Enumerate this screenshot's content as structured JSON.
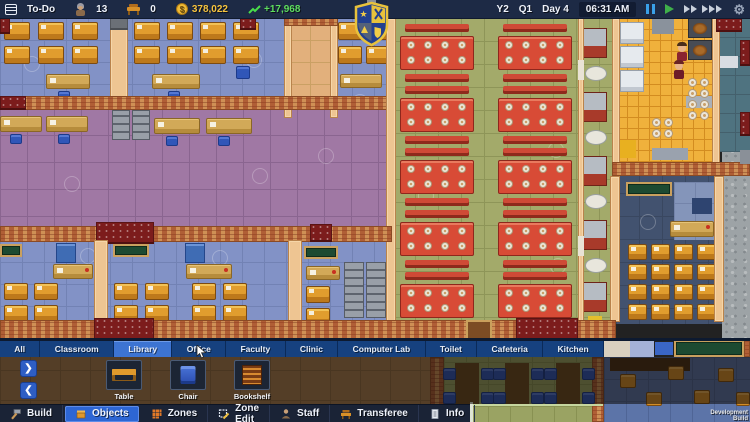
{
  "top_bar": {
    "todo_label": "To-Do",
    "students_count": "13",
    "desks_count": "0",
    "money": "378,022",
    "income": "+17,968",
    "date_year": "Y2",
    "date_quarter": "Q1",
    "date_day": "Day 4",
    "time": "06:31 AM"
  },
  "tabs": {
    "selected": "Library",
    "items": [
      "All",
      "Classroom",
      "Library",
      "Office",
      "Faculty",
      "Clinic",
      "Computer Lab",
      "Toilet",
      "Cafeteria",
      "Kitchen"
    ]
  },
  "palette": {
    "items": [
      {
        "label": "Table",
        "icon": "table-icon"
      },
      {
        "label": "Chair",
        "icon": "chair-icon"
      },
      {
        "label": "Bookshelf",
        "icon": "bookshelf-icon"
      }
    ]
  },
  "bottom_bar": {
    "items": [
      {
        "label": "Build",
        "icon": "hammer-icon",
        "selected": false
      },
      {
        "label": "Objects",
        "icon": "box-icon",
        "selected": true
      },
      {
        "label": "Zones",
        "icon": "zones-grid-icon",
        "selected": false
      },
      {
        "label": "Zone Edit",
        "icon": "zone-edit-icon",
        "selected": false
      },
      {
        "label": "Staff",
        "icon": "staff-person-icon",
        "selected": false
      },
      {
        "label": "Transferee",
        "icon": "transferee-desk-icon",
        "selected": false
      },
      {
        "label": "Info",
        "icon": "info-book-icon",
        "selected": false
      }
    ]
  },
  "watermark": "Development Build",
  "colors": {
    "topbar_bg": "#1d2a45",
    "tab_bg": "#16417f",
    "tab_selected": "#3d74d2",
    "button_selected": "#2d66d4",
    "money_yellow": "#f6c33e",
    "income_green": "#5ede5e",
    "classroom_floor": "#8292c6",
    "hall_floor": "#a078a4",
    "cafeteria_floor": "#a3aa6a",
    "kitchen_floor": "#f0b13c"
  },
  "map": {
    "items": [
      {
        "t": "floor",
        "x": 0,
        "y": 18,
        "w": 392,
        "h": 90,
        "f": "#8292c6",
        "tl": 22,
        "g": "#7282b4"
      },
      {
        "t": "floor",
        "x": 288,
        "y": 18,
        "w": 44,
        "h": 100,
        "f": "#e2b07c",
        "tl": 22,
        "g": "#caa064"
      },
      {
        "t": "floor",
        "x": 0,
        "y": 108,
        "w": 392,
        "h": 136,
        "f": "#a078a4",
        "tl": 27,
        "g": "#8a6590"
      },
      {
        "t": "floor",
        "x": 0,
        "y": 240,
        "w": 392,
        "h": 86,
        "f": "#8292c6",
        "tl": 22,
        "g": "#7282b4"
      },
      {
        "t": "floor",
        "x": 392,
        "y": 18,
        "w": 224,
        "h": 322,
        "f": "#a3aa6a",
        "tl": 23,
        "g": "#8e9558"
      },
      {
        "t": "floor",
        "x": 616,
        "y": 18,
        "w": 100,
        "h": 152,
        "f": "#f0b13c",
        "tl": 11,
        "g": "#d38c20"
      },
      {
        "t": "floor",
        "x": 716,
        "y": 18,
        "w": 34,
        "h": 134,
        "f": "#4f7380",
        "tl": 19,
        "g": "#44606c"
      },
      {
        "t": "floor",
        "x": 616,
        "y": 170,
        "w": 106,
        "h": 154,
        "f": "#42526f",
        "tl": 23,
        "g": "#394760"
      },
      {
        "t": "floor",
        "x": 674,
        "y": 182,
        "w": 42,
        "h": 58,
        "f": "#8495ba",
        "tl": 21,
        "g": "#7484aa"
      },
      {
        "t": "concrete",
        "x": 722,
        "y": 152,
        "w": 28,
        "h": 190
      },
      {
        "t": "floor",
        "x": 0,
        "y": 340,
        "w": 444,
        "h": 82,
        "f": "#a87c4e",
        "tl": 30,
        "g": "#916b42"
      },
      {
        "t": "floor",
        "x": 444,
        "y": 340,
        "w": 160,
        "h": 82,
        "f": "#9aa363",
        "tl": 22,
        "g": "#889152"
      },
      {
        "t": "floor",
        "x": 604,
        "y": 357,
        "w": 146,
        "h": 65,
        "f": "#5c74a8",
        "tl": 22,
        "g": "#4f6596"
      },
      {
        "t": "decal",
        "x": 24,
        "y": 56
      },
      {
        "t": "decal",
        "x": 246,
        "y": 52
      },
      {
        "t": "decal",
        "x": 352,
        "y": 94
      },
      {
        "t": "decal",
        "x": 64,
        "y": 176
      },
      {
        "t": "decal",
        "x": 252,
        "y": 168
      },
      {
        "t": "decal",
        "x": 318,
        "y": 148
      },
      {
        "t": "decal",
        "x": 418,
        "y": 188
      },
      {
        "t": "decal",
        "x": 548,
        "y": 142
      },
      {
        "t": "decal",
        "x": 550,
        "y": 258
      },
      {
        "t": "decal",
        "x": 80,
        "y": 248
      },
      {
        "t": "decal",
        "x": 212,
        "y": 250
      },
      {
        "t": "decal",
        "x": 640,
        "y": 214
      },
      {
        "t": "desks",
        "x": 4,
        "y": 22,
        "c": 3,
        "r": 2,
        "gx": 34,
        "gy": 24,
        "w": 26,
        "h": 18
      },
      {
        "t": "tdesk",
        "x": 46,
        "y": 74,
        "w": 44,
        "h": 15
      },
      {
        "t": "chair",
        "x": 58,
        "y": 91,
        "w": 12,
        "h": 10
      },
      {
        "t": "desks",
        "x": 134,
        "y": 22,
        "c": 4,
        "r": 2,
        "gx": 33,
        "gy": 24,
        "w": 26,
        "h": 18
      },
      {
        "t": "tdesk",
        "x": 152,
        "y": 74,
        "w": 48,
        "h": 15
      },
      {
        "t": "chair",
        "x": 168,
        "y": 91,
        "w": 12,
        "h": 10
      },
      {
        "t": "chair",
        "x": 236,
        "y": 66,
        "w": 14,
        "h": 13
      },
      {
        "t": "desks",
        "x": 338,
        "y": 22,
        "c": 2,
        "r": 2,
        "gx": 28,
        "gy": 24,
        "w": 24,
        "h": 18
      },
      {
        "t": "tdesk",
        "x": 340,
        "y": 74,
        "w": 42,
        "h": 14
      },
      {
        "t": "tdesk",
        "x": 0,
        "y": 116,
        "w": 42,
        "h": 16
      },
      {
        "t": "tdesk",
        "x": 46,
        "y": 116,
        "w": 42,
        "h": 16
      },
      {
        "t": "chair",
        "x": 10,
        "y": 134,
        "w": 12,
        "h": 10
      },
      {
        "t": "chair",
        "x": 58,
        "y": 134,
        "w": 12,
        "h": 10
      },
      {
        "t": "cab",
        "x": 112,
        "y": 110,
        "w": 18,
        "h": 30
      },
      {
        "t": "cab",
        "x": 132,
        "y": 110,
        "w": 18,
        "h": 30
      },
      {
        "t": "tdesk",
        "x": 154,
        "y": 118,
        "w": 46,
        "h": 16
      },
      {
        "t": "tdesk",
        "x": 206,
        "y": 118,
        "w": 46,
        "h": 16
      },
      {
        "t": "chair",
        "x": 166,
        "y": 136,
        "w": 12,
        "h": 10
      },
      {
        "t": "chair",
        "x": 218,
        "y": 136,
        "w": 12,
        "h": 10
      },
      {
        "t": "board",
        "x": 0,
        "y": 244,
        "w": 22,
        "h": 13
      },
      {
        "t": "bluecab",
        "x": 56,
        "y": 243,
        "w": 20,
        "h": 20
      },
      {
        "t": "tdesk",
        "x": 53,
        "y": 264,
        "w": 40,
        "h": 15,
        "rd": 1
      },
      {
        "t": "desks",
        "x": 4,
        "y": 283,
        "c": 2,
        "r": 2,
        "gx": 30,
        "gy": 22,
        "w": 24,
        "h": 17
      },
      {
        "t": "board",
        "x": 113,
        "y": 244,
        "w": 36,
        "h": 13
      },
      {
        "t": "bluecab",
        "x": 185,
        "y": 243,
        "w": 20,
        "h": 20
      },
      {
        "t": "tdesk",
        "x": 186,
        "y": 264,
        "w": 46,
        "h": 15,
        "rd": 1
      },
      {
        "t": "desks",
        "x": 114,
        "y": 283,
        "c": 2,
        "r": 2,
        "gx": 31,
        "gy": 22,
        "w": 24,
        "h": 17
      },
      {
        "t": "desks",
        "x": 192,
        "y": 283,
        "c": 2,
        "r": 2,
        "gx": 31,
        "gy": 22,
        "w": 24,
        "h": 17
      },
      {
        "t": "board",
        "x": 304,
        "y": 246,
        "w": 34,
        "h": 13
      },
      {
        "t": "tdesk",
        "x": 306,
        "y": 266,
        "w": 34,
        "h": 14,
        "rd": 1
      },
      {
        "t": "cab",
        "x": 344,
        "y": 262,
        "w": 20,
        "h": 56
      },
      {
        "t": "cab",
        "x": 366,
        "y": 262,
        "w": 20,
        "h": 56
      },
      {
        "t": "desks",
        "x": 306,
        "y": 286,
        "c": 1,
        "r": 2,
        "gx": 30,
        "gy": 22,
        "w": 24,
        "h": 17
      },
      {
        "t": "tgroup",
        "x": 400,
        "w": 74,
        "tops": [
          24,
          86,
          148,
          210,
          272
        ]
      },
      {
        "t": "tgroup",
        "x": 498,
        "w": 74,
        "tops": [
          24,
          86,
          148,
          210,
          272
        ]
      },
      {
        "t": "counter",
        "x": 583,
        "y": 28,
        "w": 24,
        "h": 30
      },
      {
        "t": "oval",
        "x": 585,
        "y": 66,
        "w": 22,
        "h": 15
      },
      {
        "t": "counter",
        "x": 583,
        "y": 92,
        "w": 24,
        "h": 30
      },
      {
        "t": "oval",
        "x": 585,
        "y": 130,
        "w": 22,
        "h": 15
      },
      {
        "t": "counter",
        "x": 583,
        "y": 156,
        "w": 24,
        "h": 30
      },
      {
        "t": "oval",
        "x": 585,
        "y": 194,
        "w": 22,
        "h": 15
      },
      {
        "t": "counter",
        "x": 583,
        "y": 220,
        "w": 24,
        "h": 30
      },
      {
        "t": "oval",
        "x": 585,
        "y": 258,
        "w": 22,
        "h": 15
      },
      {
        "t": "counter",
        "x": 583,
        "y": 282,
        "w": 24,
        "h": 30
      },
      {
        "t": "box",
        "x": 588,
        "y": 316,
        "w": 14,
        "h": 12,
        "f": "#e4be2c"
      },
      {
        "t": "fridge",
        "x": 620,
        "y": 22,
        "w": 24,
        "h": 22
      },
      {
        "t": "fridge",
        "x": 620,
        "y": 46,
        "w": 24,
        "h": 22
      },
      {
        "t": "fridge",
        "x": 620,
        "y": 70,
        "w": 24,
        "h": 22
      },
      {
        "t": "box",
        "x": 652,
        "y": 18,
        "w": 22,
        "h": 16,
        "f": "#8a929c"
      },
      {
        "t": "stove",
        "x": 688,
        "y": 18,
        "w": 24,
        "h": 20
      },
      {
        "t": "stove",
        "x": 688,
        "y": 40,
        "w": 24,
        "h": 20
      },
      {
        "t": "person",
        "x": 676,
        "y": 42,
        "hr": "#4a2e1a",
        "sh": "#8a2430"
      },
      {
        "t": "person",
        "x": 673,
        "y": 60,
        "hr": "#6a2424",
        "sh": "#6e1c28"
      },
      {
        "t": "box",
        "x": 686,
        "y": 96,
        "w": 28,
        "h": 12,
        "f": "#aab0b8"
      },
      {
        "t": "plates",
        "x": 688,
        "y": 78,
        "c": 2,
        "r": 4
      },
      {
        "t": "plates",
        "x": 652,
        "y": 118,
        "c": 2,
        "r": 2
      },
      {
        "t": "box",
        "x": 652,
        "y": 148,
        "w": 36,
        "h": 12,
        "f": "#9aa2ae"
      },
      {
        "t": "box",
        "x": 620,
        "y": 140,
        "w": 16,
        "h": 18,
        "f": "#e8b020"
      },
      {
        "t": "box",
        "x": 718,
        "y": 56,
        "w": 20,
        "h": 12,
        "f": "#d8dce2"
      },
      {
        "t": "board",
        "x": 626,
        "y": 182,
        "w": 46,
        "h": 14
      },
      {
        "t": "box",
        "x": 692,
        "y": 198,
        "w": 20,
        "h": 16,
        "f": "#2e4470"
      },
      {
        "t": "tdesk",
        "x": 670,
        "y": 221,
        "w": 44,
        "h": 16,
        "rd": 1
      },
      {
        "t": "desks",
        "x": 628,
        "y": 244,
        "c": 4,
        "r": 4,
        "gx": 23,
        "gy": 20,
        "w": 19,
        "h": 16
      },
      {
        "t": "wall",
        "x": 110,
        "y": 18,
        "w": 18,
        "h": 90
      },
      {
        "t": "graycap",
        "x": 110,
        "y": 18,
        "w": 18,
        "h": 12
      },
      {
        "t": "wall",
        "x": 284,
        "y": 18,
        "w": 8,
        "h": 100
      },
      {
        "t": "wall",
        "x": 330,
        "y": 18,
        "w": 8,
        "h": 100
      },
      {
        "t": "brick",
        "x": 284,
        "y": 18,
        "w": 54,
        "h": 8
      },
      {
        "t": "maroon",
        "x": 0,
        "y": 18,
        "w": 10,
        "h": 16
      },
      {
        "t": "maroon",
        "x": 240,
        "y": 18,
        "w": 16,
        "h": 12
      },
      {
        "t": "maroon",
        "x": 384,
        "y": 18,
        "w": 10,
        "h": 16
      },
      {
        "t": "brick",
        "x": 0,
        "y": 96,
        "w": 392,
        "h": 14
      },
      {
        "t": "maroon",
        "x": 0,
        "y": 96,
        "w": 26,
        "h": 14
      },
      {
        "t": "wall",
        "x": 386,
        "y": 18,
        "w": 10,
        "h": 322
      },
      {
        "t": "brick",
        "x": 0,
        "y": 226,
        "w": 392,
        "h": 16
      },
      {
        "t": "maroon",
        "x": 96,
        "y": 222,
        "w": 58,
        "h": 22
      },
      {
        "t": "maroon",
        "x": 310,
        "y": 224,
        "w": 22,
        "h": 18
      },
      {
        "t": "wall",
        "x": 94,
        "y": 240,
        "w": 14,
        "h": 86
      },
      {
        "t": "wall",
        "x": 288,
        "y": 240,
        "w": 14,
        "h": 86
      },
      {
        "t": "wall",
        "x": 578,
        "y": 18,
        "w": 6,
        "h": 322
      },
      {
        "t": "box",
        "x": 578,
        "y": 60,
        "w": 6,
        "h": 20,
        "f": "#e9e3d5"
      },
      {
        "t": "box",
        "x": 578,
        "y": 236,
        "w": 6,
        "h": 20,
        "f": "#e9e3d5"
      },
      {
        "t": "wall",
        "x": 612,
        "y": 18,
        "w": 8,
        "h": 152
      },
      {
        "t": "wall",
        "x": 712,
        "y": 18,
        "w": 8,
        "h": 152
      },
      {
        "t": "brick",
        "x": 612,
        "y": 162,
        "w": 138,
        "h": 14
      },
      {
        "t": "maroon",
        "x": 716,
        "y": 18,
        "w": 26,
        "h": 14
      },
      {
        "t": "maroon",
        "x": 740,
        "y": 40,
        "w": 10,
        "h": 26
      },
      {
        "t": "maroon",
        "x": 740,
        "y": 112,
        "w": 10,
        "h": 24
      },
      {
        "t": "wall",
        "x": 610,
        "y": 176,
        "w": 10,
        "h": 146
      },
      {
        "t": "wall",
        "x": 714,
        "y": 176,
        "w": 10,
        "h": 146
      },
      {
        "t": "brick",
        "x": 0,
        "y": 320,
        "w": 616,
        "h": 22
      },
      {
        "t": "maroon",
        "x": 94,
        "y": 318,
        "w": 60,
        "h": 24
      },
      {
        "t": "maroon",
        "x": 516,
        "y": 318,
        "w": 62,
        "h": 24
      },
      {
        "t": "door",
        "x": 466,
        "y": 320,
        "w": 26,
        "h": 20
      },
      {
        "t": "box",
        "x": 740,
        "y": 150,
        "w": 10,
        "h": 14,
        "f": "#8a9098"
      },
      {
        "t": "box",
        "x": 604,
        "y": 340,
        "w": 26,
        "h": 17,
        "f": "#d9d0bf"
      },
      {
        "t": "box",
        "x": 630,
        "y": 340,
        "w": 24,
        "h": 17,
        "f": "#a4b2d8"
      },
      {
        "t": "box",
        "x": 655,
        "y": 342,
        "w": 18,
        "h": 13,
        "f": "#3a66c6"
      },
      {
        "t": "board",
        "x": 674,
        "y": 340,
        "w": 70,
        "h": 17
      },
      {
        "t": "brick",
        "x": 744,
        "y": 340,
        "w": 6,
        "h": 17
      },
      {
        "t": "brick",
        "x": 430,
        "y": 357,
        "w": 14,
        "h": 65
      },
      {
        "t": "brick",
        "x": 592,
        "y": 357,
        "w": 12,
        "h": 65
      },
      {
        "t": "box",
        "x": 455,
        "y": 363,
        "w": 24,
        "h": 42,
        "f": "#6b4a20"
      },
      {
        "t": "box",
        "x": 505,
        "y": 363,
        "w": 24,
        "h": 42,
        "f": "#6b4a20"
      },
      {
        "t": "box",
        "x": 556,
        "y": 363,
        "w": 24,
        "h": 42,
        "f": "#6b4a20"
      },
      {
        "t": "chairs",
        "x": 443,
        "y": 368,
        "c": 2,
        "r": 2,
        "gx": 38,
        "gy": 24,
        "w": 13,
        "h": 12
      },
      {
        "t": "chairs",
        "x": 493,
        "y": 368,
        "c": 2,
        "r": 2,
        "gx": 38,
        "gy": 24,
        "w": 13,
        "h": 12
      },
      {
        "t": "chairs",
        "x": 544,
        "y": 368,
        "c": 2,
        "r": 2,
        "gx": 38,
        "gy": 24,
        "w": 13,
        "h": 12
      },
      {
        "t": "box",
        "x": 610,
        "y": 358,
        "w": 80,
        "h": 13,
        "f": "#4a3014"
      },
      {
        "t": "ochair",
        "x": 620,
        "y": 374,
        "w": 16,
        "h": 14
      },
      {
        "t": "ochair",
        "x": 646,
        "y": 392,
        "w": 16,
        "h": 14
      },
      {
        "t": "ochair",
        "x": 668,
        "y": 366,
        "w": 16,
        "h": 14
      },
      {
        "t": "ochair",
        "x": 694,
        "y": 390,
        "w": 16,
        "h": 14
      },
      {
        "t": "ochair",
        "x": 718,
        "y": 368,
        "w": 16,
        "h": 14
      },
      {
        "t": "ochair",
        "x": 736,
        "y": 392,
        "w": 14,
        "h": 14
      },
      {
        "t": "box",
        "x": 470,
        "y": 402,
        "w": 3,
        "h": 20,
        "f": "#dfe5d6"
      },
      {
        "t": "box",
        "x": 473,
        "y": 404,
        "w": 130,
        "h": 2,
        "f": "#c6d69e"
      }
    ]
  }
}
